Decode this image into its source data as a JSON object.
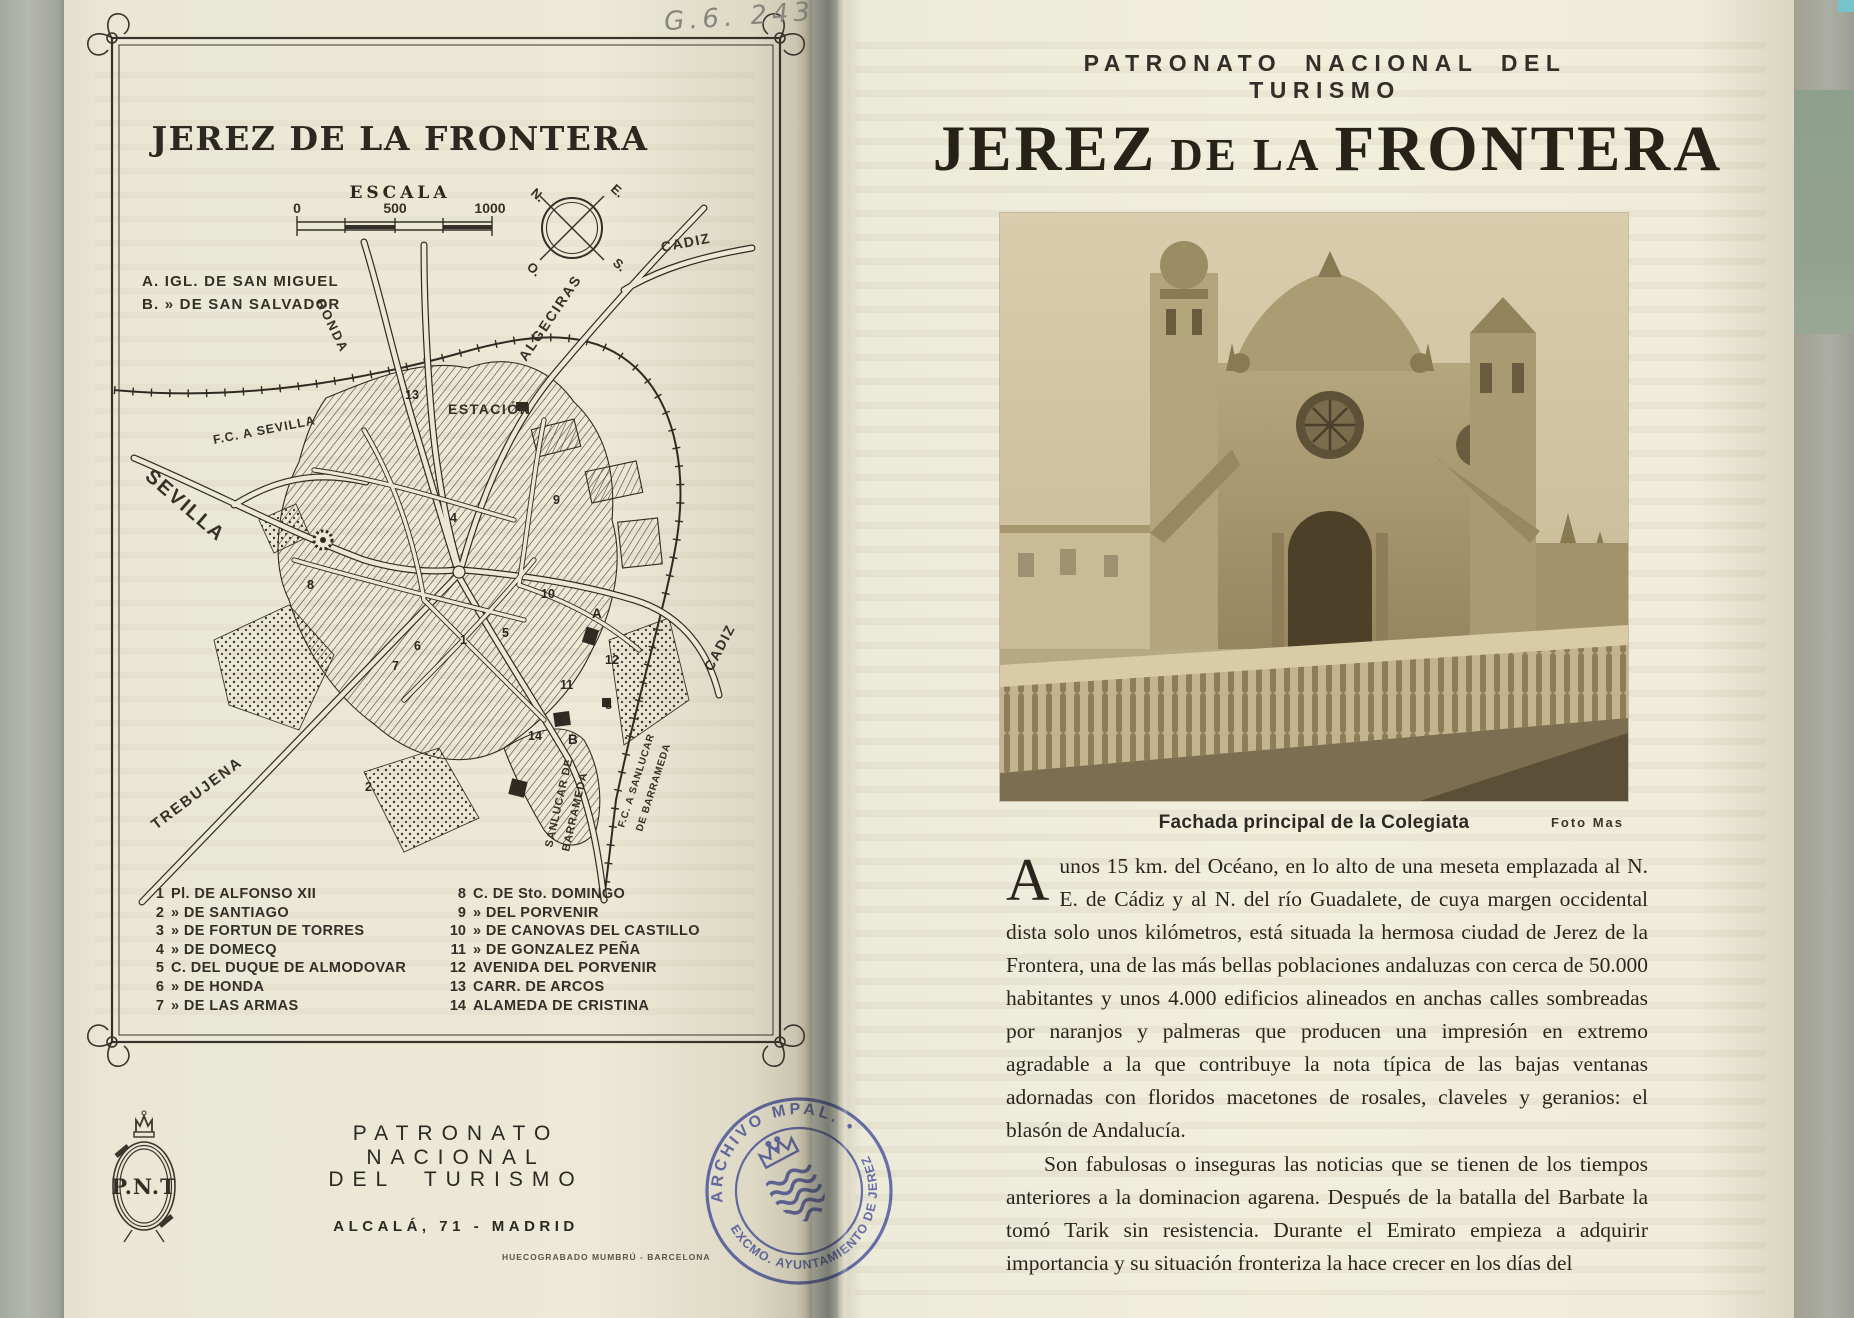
{
  "scan": {
    "handwritten_code": "G.6. 243"
  },
  "left_page": {
    "map": {
      "title": "JEREZ DE LA FRONTERA",
      "scale_title": "ESCALA",
      "scale_ticks": [
        "0",
        "500",
        "1000"
      ],
      "compass": {
        "n": "N.",
        "e": "E.",
        "s": "S.",
        "o": "O."
      },
      "key_line_a": "A. IGL. DE SAN MIGUEL",
      "key_line_b": "B.  »    DE SAN SALVADOR",
      "labels": {
        "ronda": "RONDA",
        "algeciras": "ALGECIRAS",
        "cadiz_north": "CADIZ",
        "estacion": "ESTACIÓN",
        "fc_sevilla": "F.C. A SEVILLA",
        "sevilla": "SEVILLA",
        "trebujena": "TREBUJENA",
        "cadiz_east": "CADIZ",
        "sanlucar_1": "SANLUCAR DE",
        "sanlucar_2": "BARRAMEDA",
        "fc_sanlucar_1": "F.C. A SANLUCAR",
        "fc_sanlucar_2": "DE BARRAMEDA"
      },
      "markers": {
        "n1": "1",
        "n2": "2",
        "n3": "3",
        "n4": "4",
        "n5": "5",
        "n6": "6",
        "n7": "7",
        "n8": "8",
        "n9": "9",
        "n10": "10",
        "n11": "11",
        "n12": "12",
        "n13": "13",
        "n14": "14",
        "a": "A",
        "b": "B"
      },
      "legend_left": [
        {
          "num": "1",
          "text": "Pl. DE ALFONSO XII"
        },
        {
          "num": "2",
          "text": "»   DE SANTIAGO"
        },
        {
          "num": "3",
          "text": "»   DE FORTUN DE TORRES"
        },
        {
          "num": "4",
          "text": "»   DE DOMECQ"
        },
        {
          "num": "5",
          "text": "C. DEL DUQUE DE ALMODOVAR"
        },
        {
          "num": "6",
          "text": "»   DE HONDA"
        },
        {
          "num": "7",
          "text": "»   DE LAS ARMAS"
        }
      ],
      "legend_right": [
        {
          "num": "8",
          "text": "C. DE Sto. DOMINGO"
        },
        {
          "num": "9",
          "text": "»   DEL PORVENIR"
        },
        {
          "num": "10",
          "text": "»   DE CANOVAS DEL CASTILLO"
        },
        {
          "num": "11",
          "text": "»   DE GONZALEZ PEÑA"
        },
        {
          "num": "12",
          "text": "AVENIDA DEL PORVENIR"
        },
        {
          "num": "13",
          "text": "CARR. DE ARCOS"
        },
        {
          "num": "14",
          "text": "ALAMEDA DE CRISTINA"
        }
      ]
    },
    "publisher": {
      "logo": "P.N.T",
      "name_line1": "PATRONATO NACIONAL",
      "name_line2": "DEL TURISMO",
      "address": "ALCALÁ, 71 - MADRID",
      "printer": "HUECOGRABADO MUMBRÚ - BARCELONA"
    },
    "stamp": {
      "arc_top": "ARCHIVO MPAL. •",
      "arc_bottom": "EXCMO. AYUNTAMIENTO DE JEREZ",
      "color": "#5560c0"
    }
  },
  "right_page": {
    "kicker": "PATRONATO NACIONAL DEL TURISMO",
    "title": {
      "word1": "JEREZ",
      "connector": "DE LA",
      "word2": "FRONTERA"
    },
    "photo": {
      "caption": "Fachada principal de la Colegiata",
      "credit": "Foto Mas"
    },
    "body": {
      "drop_cap": "A",
      "paragraph1": "unos 15 km. del Océano, en lo alto de una meseta emplazada al N. E. de Cádiz y al N. del río Guadalete, de cuya margen occidental dista solo unos kilómetros, está situada la hermosa ciudad de Jerez de la Frontera, una de las más bellas poblaciones andaluzas con cerca de 50.000 habitantes y unos 4.000 edificios alineados en anchas calles sombreadas por naranjos y palmeras que producen una impresión en extremo agradable a la que contribuye la nota típica de las bajas ventanas adornadas con floridos macetones de rosales, claveles y geranios: el blasón de Andalucía.",
      "paragraph2": "Son fabulosas o inseguras las noticias que se tienen de los tiempos anteriores a la dominacion agarena. Después de la batalla del Barbate la tomó Tarik sin resistencia. Durante el Emirato empieza a adquirir importancia y su situación fronteriza la hace crecer en los días del"
    }
  }
}
